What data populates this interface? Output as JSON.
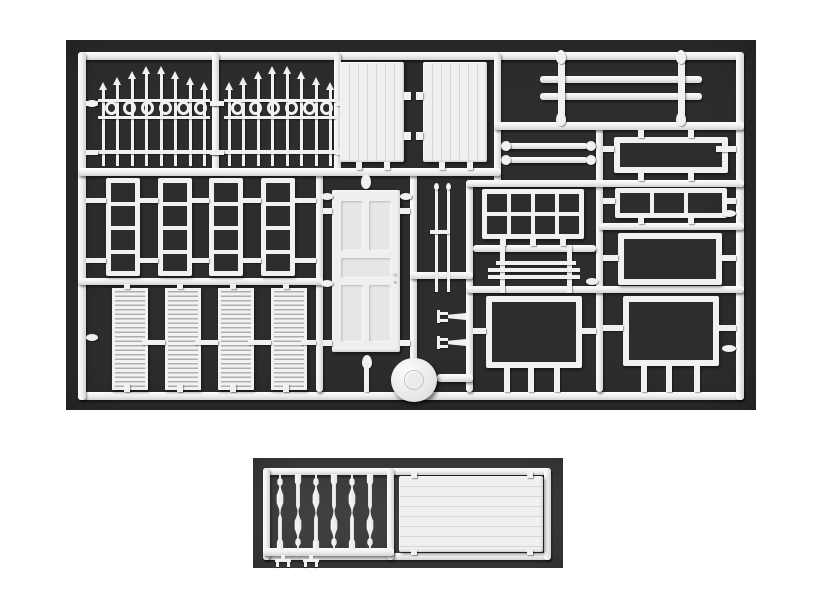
{
  "scene": {
    "description": "Photograph of two white injection-moulded plastic model sprues of architectural parts laid on dark grey backgrounds",
    "main_sprue_label": "large sprue with fences, doors, windows, shutters and frames",
    "small_sprue_label": "small sprue with turned balusters and a planked wall panel"
  },
  "colors": {
    "page_bg": "#ffffff",
    "main_photo_bg": "#2d2d2d",
    "small_photo_bg": "#404040",
    "plastic": "#f1f1f1",
    "plastic_highlight": "#fdfdfd",
    "plastic_shadow": "#d2d2d2"
  },
  "main_sprue": {
    "parts": [
      {
        "name": "ornamental fence section with spear finials and ring band",
        "count": 2
      },
      {
        "name": "vertical planked door panel with hinge tabs",
        "count": 2
      },
      {
        "name": "double handrail with two finial posts",
        "count": 1
      },
      {
        "name": "short railing bar with end knobs",
        "count": 2
      },
      {
        "name": "open rectangular frame, small",
        "count": 1
      },
      {
        "name": "three-pane window strip",
        "count": 1
      },
      {
        "name": "open rectangular frame, medium",
        "count": 1
      },
      {
        "name": "open rectangular frame, large",
        "count": 2
      },
      {
        "name": "eight-pane window 4x2",
        "count": 1
      },
      {
        "name": "triple-rail gate section",
        "count": 1
      },
      {
        "name": "four-pane sash window",
        "count": 4
      },
      {
        "name": "four-panel door with knob",
        "count": 1
      },
      {
        "name": "louvred shutter",
        "count": 4
      },
      {
        "name": "thin post rod",
        "count": 2
      },
      {
        "name": "small wall bracket",
        "count": 2
      },
      {
        "name": "round mould disc with embossed mark",
        "count": 1
      }
    ]
  },
  "small_sprue": {
    "parts": [
      {
        "name": "turned baluster",
        "count": 6
      },
      {
        "name": "small T-shaped foot",
        "count": 2
      },
      {
        "name": "horizontal planked wall panel",
        "count": 1
      }
    ]
  }
}
